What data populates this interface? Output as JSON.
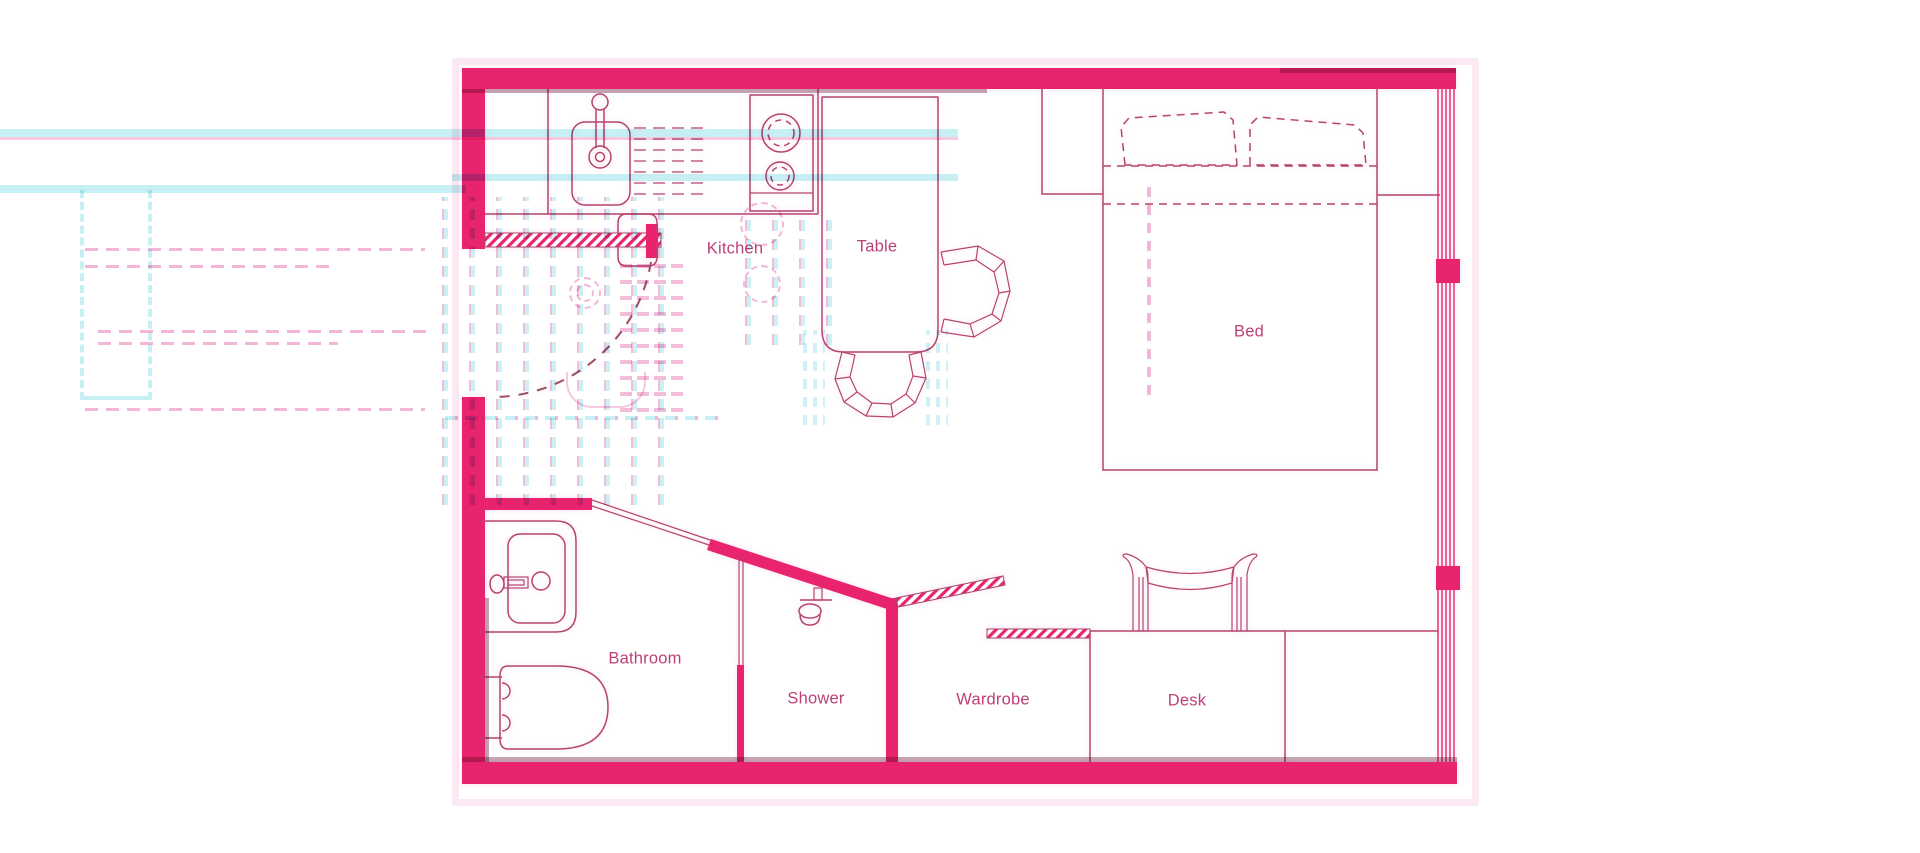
{
  "rooms": {
    "kitchen": {
      "label": "Kitchen"
    },
    "table": {
      "label": "Table"
    },
    "bed": {
      "label": "Bed"
    },
    "bathroom": {
      "label": "Bathroom"
    },
    "shower": {
      "label": "Shower"
    },
    "wardrobe": {
      "label": "Wardrobe"
    },
    "desk": {
      "label": "Desk"
    }
  },
  "fixtures": [
    "entry-door-icon",
    "door-swing-arc-icon",
    "kitchen-sink-icon",
    "dish-rack-icon",
    "stove-icon",
    "dining-table-icon",
    "chair-icon",
    "bed-icon",
    "pillow-icon",
    "nightstand-niche",
    "window-wall-icon",
    "bathroom-sink-icon",
    "toilet-icon",
    "shower-head-icon",
    "wardrobe-door-icon",
    "desk-icon",
    "desk-chair-icon"
  ],
  "colors": {
    "wall": "#E8246F",
    "line": "#B5446F",
    "label": "#BC4078",
    "arc": "#9B4E63",
    "artifact_cyan": "#C6F0F4",
    "ghost_pink": "#F2B6D6",
    "ghost_pink_light": "#F8C8E0",
    "ghost_dark": "#8C5068",
    "halo": "#FAD6E8"
  }
}
